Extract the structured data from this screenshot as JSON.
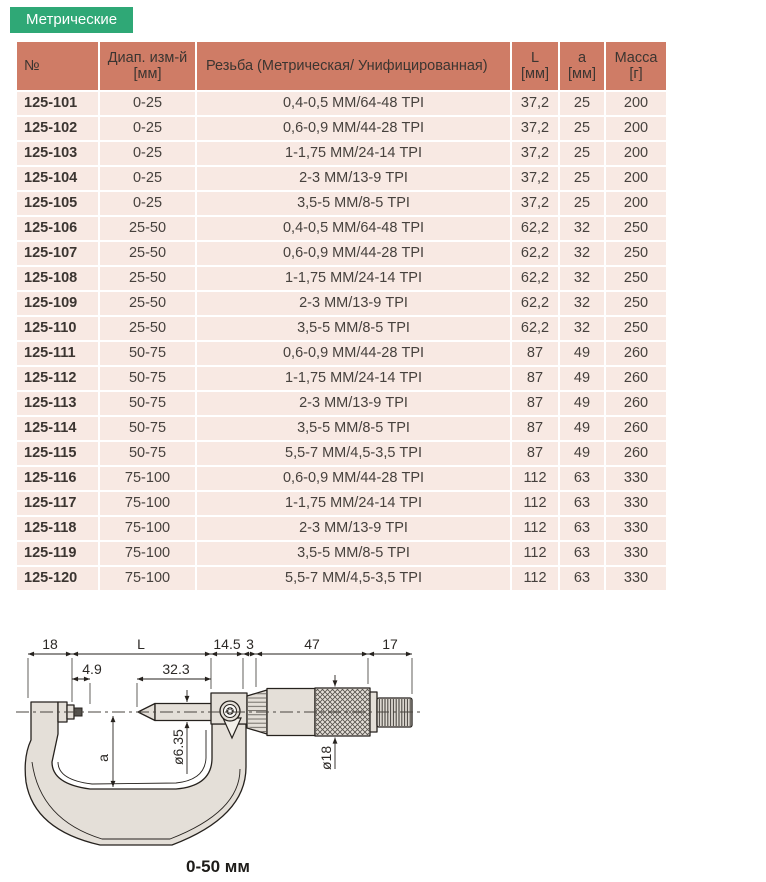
{
  "tab": {
    "label": "Метрические"
  },
  "table": {
    "columns": [
      {
        "key": "no",
        "label": "№",
        "unit": ""
      },
      {
        "key": "range",
        "label": "Диап. изм-й",
        "unit": "[мм]"
      },
      {
        "key": "thread",
        "label": "Резьба (Метрическая/ Унифицированная)",
        "unit": ""
      },
      {
        "key": "L",
        "label": "L",
        "unit": "[мм]"
      },
      {
        "key": "a",
        "label": "a",
        "unit": "[мм]"
      },
      {
        "key": "mass",
        "label": "Масса",
        "unit": "[г]"
      }
    ],
    "rows": [
      [
        "125-101",
        "0-25",
        "0,4-0,5 ММ/64-48 TPI",
        "37,2",
        "25",
        "200"
      ],
      [
        "125-102",
        "0-25",
        "0,6-0,9 ММ/44-28 TPI",
        "37,2",
        "25",
        "200"
      ],
      [
        "125-103",
        "0-25",
        "1-1,75 ММ/24-14 TPI",
        "37,2",
        "25",
        "200"
      ],
      [
        "125-104",
        "0-25",
        "2-3 ММ/13-9 TPI",
        "37,2",
        "25",
        "200"
      ],
      [
        "125-105",
        "0-25",
        "3,5-5 ММ/8-5 TPI",
        "37,2",
        "25",
        "200"
      ],
      [
        "125-106",
        "25-50",
        "0,4-0,5 ММ/64-48 TPI",
        "62,2",
        "32",
        "250"
      ],
      [
        "125-107",
        "25-50",
        "0,6-0,9 ММ/44-28 TPI",
        "62,2",
        "32",
        "250"
      ],
      [
        "125-108",
        "25-50",
        "1-1,75 ММ/24-14 TPI",
        "62,2",
        "32",
        "250"
      ],
      [
        "125-109",
        "25-50",
        "2-3 ММ/13-9 TPI",
        "62,2",
        "32",
        "250"
      ],
      [
        "125-110",
        "25-50",
        "3,5-5 ММ/8-5 TPI",
        "62,2",
        "32",
        "250"
      ],
      [
        "125-111",
        "50-75",
        "0,6-0,9 ММ/44-28 TPI",
        "87",
        "49",
        "260"
      ],
      [
        "125-112",
        "50-75",
        "1-1,75 ММ/24-14 TPI",
        "87",
        "49",
        "260"
      ],
      [
        "125-113",
        "50-75",
        "2-3 ММ/13-9 TPI",
        "87",
        "49",
        "260"
      ],
      [
        "125-114",
        "50-75",
        "3,5-5 ММ/8-5 TPI",
        "87",
        "49",
        "260"
      ],
      [
        "125-115",
        "50-75",
        "5,5-7 ММ/4,5-3,5 TPI",
        "87",
        "49",
        "260"
      ],
      [
        "125-116",
        "75-100",
        "0,6-0,9 ММ/44-28 TPI",
        "112",
        "63",
        "330"
      ],
      [
        "125-117",
        "75-100",
        "1-1,75 ММ/24-14 TPI",
        "112",
        "63",
        "330"
      ],
      [
        "125-118",
        "75-100",
        "2-3 ММ/13-9 TPI",
        "112",
        "63",
        "330"
      ],
      [
        "125-119",
        "75-100",
        "3,5-5 ММ/8-5 TPI",
        "112",
        "63",
        "330"
      ],
      [
        "125-120",
        "75-100",
        "5,5-7 ММ/4,5-3,5 TPI",
        "112",
        "63",
        "330"
      ]
    ]
  },
  "diagram": {
    "labels": {
      "top1": "18",
      "top2": "L",
      "top3": "14.5",
      "top4": "3",
      "top5": "47",
      "top6": "17",
      "sub1": "4.9",
      "sub2": "32.3",
      "vert_a": "a",
      "vert_spindle": "ø6.35",
      "vert_thimble": "ø18"
    },
    "caption": "0-50 мм"
  },
  "colors": {
    "tab_green": "#2FA876",
    "header_salmon": "#CF7C66",
    "row_pink": "#F8E9E3",
    "diagram_fill": "#E4DFD8"
  }
}
